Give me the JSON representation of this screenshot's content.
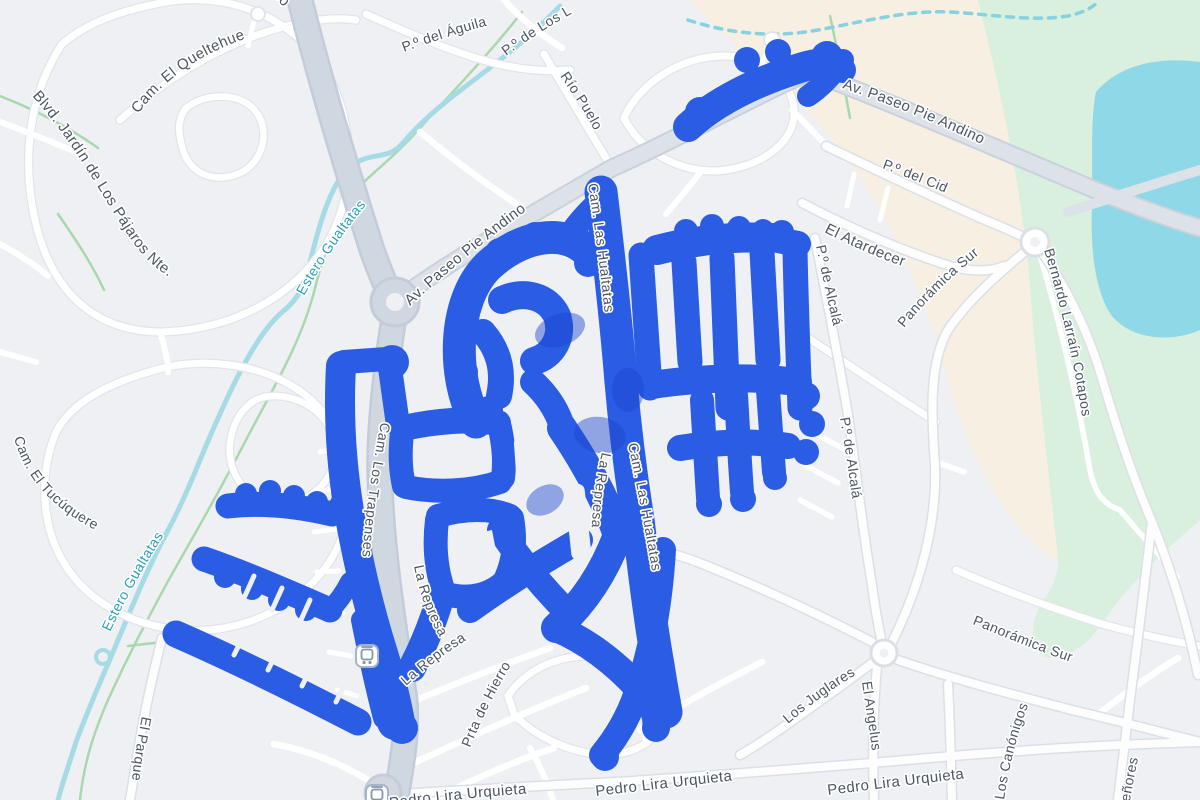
{
  "map": {
    "colors": {
      "background": "#eef0f4",
      "route_blue": "#2a5ce4",
      "route_dark_blue": "#1d45cd",
      "water_line": "#a6dbe5",
      "water_dashed": "#86d2e0",
      "lake": "#8ed8e8",
      "park_green": "#d9f0de",
      "sand_beige": "#f6efe2",
      "trail_green": "#a9d8ae",
      "road_major_fill": "#cfd7e1",
      "road_major_casing": "#c3ccd8",
      "road_minor_fill": "#ffffff",
      "road_minor_casing": "#e1e5ea",
      "street_label_color": "#4b5563",
      "water_label_color": "#2aa0b8"
    },
    "street_labels": [
      {
        "id": "andino-top",
        "text": "Andino",
        "kind": "street",
        "size": 15,
        "path": "M 252,-30 L 320,50"
      },
      {
        "id": "queltehue",
        "text": "Cam. El Queltehue",
        "kind": "street",
        "size": 15,
        "path": "M 138,114 C 170,72 210,48 266,32"
      },
      {
        "id": "blvd-jardin",
        "text": "Blvd. Jardín de Los Pájaros Nte.",
        "kind": "street",
        "size": 15,
        "path": "M 32,96 C 72,140 96,186 126,232 C 146,264 170,282 208,296"
      },
      {
        "id": "aguila",
        "text": "P.º del Águila",
        "kind": "street",
        "size": 14,
        "path": "M 404,52 C 436,40 468,30 502,22"
      },
      {
        "id": "de-los-l",
        "text": "P.º de Los L",
        "kind": "street",
        "size": 14,
        "path": "M 506,56 C 530,38 556,22 582,8"
      },
      {
        "id": "rio-puelo",
        "text": "Río Puelo",
        "kind": "street",
        "size": 14,
        "path": "M 560,76 C 576,98 590,120 600,142"
      },
      {
        "id": "estero-upper",
        "text": "Estero Gualtatas",
        "kind": "water",
        "size": 14,
        "path": "M 304,296 C 324,260 346,228 372,198"
      },
      {
        "id": "estero-lower",
        "text": "Estero Gualtatas",
        "kind": "water",
        "size": 14,
        "path": "M 110,632 C 130,590 152,552 178,514"
      },
      {
        "id": "andino-mid",
        "text": "Av. Paseo Pie Andino",
        "kind": "street",
        "size": 15,
        "path": "M 410,306 C 458,262 506,224 558,188"
      },
      {
        "id": "andino-tr",
        "text": "Av. Paseo Pie Andino",
        "kind": "street",
        "size": 15,
        "path": "M 842,88 C 896,106 950,128 1002,154"
      },
      {
        "id": "cid",
        "text": "P.º del Cid",
        "kind": "street",
        "size": 14,
        "path": "M 882,168 C 910,178 938,190 968,202"
      },
      {
        "id": "atardecer",
        "text": "El Atardecer",
        "kind": "street",
        "size": 15,
        "path": "M 824,232 C 856,248 888,262 920,272"
      },
      {
        "id": "panoramica-upper",
        "text": "Panorámica Sur",
        "kind": "street",
        "size": 14,
        "path": "M 904,328 C 930,296 962,266 998,240"
      },
      {
        "id": "cotapos",
        "text": "Bernardo Larraín Cotapos",
        "kind": "street",
        "size": 14,
        "path": "M 1044,250 C 1062,310 1076,370 1084,430 L 1090,456"
      },
      {
        "id": "alcala-upper",
        "text": "P.º de Alcalá",
        "kind": "street",
        "size": 14,
        "path": "M 816,246 C 824,284 832,322 842,362"
      },
      {
        "id": "alcala-lower",
        "text": "P.º de Alcalá",
        "kind": "street",
        "size": 14,
        "path": "M 840,418 C 846,452 850,486 856,522"
      },
      {
        "id": "trapenses",
        "text": "Cam. Los Trapenses",
        "kind": "street",
        "size": 14,
        "path": "M 381,422 C 372,468 365,514 362,562"
      },
      {
        "id": "hualtatas-upper",
        "text": "Cam. Las Hualtatas",
        "kind": "street",
        "size": 14,
        "path": "M 588,184 C 596,234 602,284 607,336"
      },
      {
        "id": "hualtatas-lower",
        "text": "Cam. Las Hualtatas",
        "kind": "street",
        "size": 14,
        "path": "M 628,444 C 640,500 650,556 659,614"
      },
      {
        "id": "represa-upper",
        "text": "La Represa",
        "kind": "street",
        "size": 14,
        "path": "M 602,452 C 594,488 590,524 592,560"
      },
      {
        "id": "represa-mid",
        "text": "La Represa",
        "kind": "street",
        "size": 14,
        "path": "M 414,566 C 420,598 432,628 452,656"
      },
      {
        "id": "represa-diag",
        "text": "La Represa",
        "kind": "street",
        "size": 14,
        "path": "M 406,686 C 428,666 452,648 480,632"
      },
      {
        "id": "prta-hierro",
        "text": "Prta de Hierro",
        "kind": "street",
        "size": 14,
        "path": "M 470,748 C 486,708 506,670 530,636"
      },
      {
        "id": "el-parque",
        "text": "El Parque",
        "kind": "street",
        "size": 14,
        "path": "M 142,716 C 136,746 132,774 130,802"
      },
      {
        "id": "tucuquere",
        "text": "Cam. El Tucúquere",
        "kind": "street",
        "size": 14,
        "path": "M 14,438 C 26,480 54,512 110,537"
      },
      {
        "id": "juglares",
        "text": "Los Juglares",
        "kind": "street",
        "size": 14,
        "path": "M 788,724 C 812,703 838,684 868,668"
      },
      {
        "id": "angelus",
        "text": "El Angelus",
        "kind": "street",
        "size": 14,
        "path": "M 862,682 C 866,710 871,738 874,768"
      },
      {
        "id": "panoramica-lower",
        "text": "Panorámica Sur",
        "kind": "street",
        "size": 14,
        "path": "M 972,624 C 1012,640 1050,656 1090,668"
      },
      {
        "id": "canonigos",
        "text": "Los Canónigos",
        "kind": "street",
        "size": 14,
        "path": "M 1004,800 C 1010,760 1020,722 1036,686"
      },
      {
        "id": "senores",
        "text": "Señores",
        "kind": "street",
        "size": 14,
        "path": "M 1128,812 C 1134,776 1141,742 1150,708"
      },
      {
        "id": "urquieta-1",
        "text": "Pedro Lira Urquieta",
        "kind": "street",
        "size": 15,
        "path": "M 390,808 C 450,799 510,794 572,791"
      },
      {
        "id": "urquieta-2",
        "text": "Pedro Lira Urquieta",
        "kind": "street",
        "size": 15,
        "path": "M 596,796 C 648,790 700,784 754,778"
      },
      {
        "id": "urquieta-3",
        "text": "Pedro Lira Urquieta",
        "kind": "street",
        "size": 15,
        "path": "M 828,795 C 882,788 934,782 992,775"
      }
    ],
    "route_strokes": [
      {
        "d": "M 688,127 C 715,102 755,82 800,68 C 815,63 828,62 838,66",
        "w": 30
      },
      {
        "d": "M 843,60 C 832,76 820,88 808,96",
        "w": 22
      },
      {
        "d": "M 601,192 C 608,250 615,310 620,370 C 624,420 630,470 638,520 C 644,570 650,620 658,665 C 661,685 664,700 666,712",
        "w": 33
      },
      {
        "d": "M 572,232 C 584,216 596,204 606,197",
        "w": 24
      },
      {
        "d": "M 476,422 C 452,378 452,302 488,266 C 520,236 562,228 586,250",
        "w": 33
      },
      {
        "d": "M 502,300 C 524,290 548,296 557,316 C 564,336 553,356 534,361",
        "w": 28
      },
      {
        "d": "M 483,332 C 497,348 505,368 499,396",
        "w": 26
      },
      {
        "d": "M 533,382 C 546,394 556,408 562,426",
        "w": 26
      },
      {
        "d": "M 657,250 C 695,240 735,236 772,238",
        "w": 30
      },
      {
        "d": "M 778,240 L 798,244",
        "w": 26
      },
      {
        "d": "M 641,255 C 644,300 647,345 650,388",
        "w": 25
      },
      {
        "d": "M 684,262 C 686,300 688,330 690,362",
        "w": 25
      },
      {
        "d": "M 722,258 C 724,305 726,360 728,408",
        "w": 25
      },
      {
        "d": "M 762,252 C 764,290 766,325 768,360",
        "w": 25
      },
      {
        "d": "M 795,250 C 796,300 798,355 800,408",
        "w": 25
      },
      {
        "d": "M 652,385 C 700,378 750,376 798,382",
        "w": 28
      },
      {
        "d": "M 680,448 C 715,442 750,440 788,446",
        "w": 26
      },
      {
        "d": "M 702,400 C 704,435 706,470 708,498",
        "w": 24
      },
      {
        "d": "M 736,395 C 738,430 740,465 742,492",
        "w": 24
      },
      {
        "d": "M 768,390 C 770,418 772,448 774,472",
        "w": 24
      },
      {
        "d": "M 622,372 C 635,378 648,382 658,385",
        "w": 24
      },
      {
        "d": "M 404,428 C 435,421 470,418 498,423",
        "w": 26
      },
      {
        "d": "M 402,432 C 400,452 400,468 404,486",
        "w": 24
      },
      {
        "d": "M 500,428 C 504,448 505,462 503,478",
        "w": 24
      },
      {
        "d": "M 406,487 C 435,493 470,492 500,482",
        "w": 24
      },
      {
        "d": "M 438,516 C 465,508 492,508 510,516",
        "w": 24
      },
      {
        "d": "M 437,520 C 434,545 436,570 444,592",
        "w": 24
      },
      {
        "d": "M 512,518 C 516,540 514,560 506,578",
        "w": 24
      },
      {
        "d": "M 446,594 C 468,600 490,596 506,580",
        "w": 24
      },
      {
        "d": "M 470,610 C 505,585 545,560 580,540",
        "w": 26
      },
      {
        "d": "M 500,530 C 520,560 545,590 570,615",
        "w": 26
      },
      {
        "d": "M 442,592 C 434,620 424,645 412,668",
        "w": 28
      },
      {
        "d": "M 390,368 L 398,425",
        "w": 24
      },
      {
        "d": "M 344,362 L 386,359",
        "w": 24
      },
      {
        "d": "M 562,428 C 585,462 605,498 618,535",
        "w": 30
      },
      {
        "d": "M 618,535 C 603,575 582,605 556,628",
        "w": 30
      },
      {
        "d": "M 556,628 C 585,640 615,662 640,690 C 652,702 658,716 656,728",
        "w": 28
      },
      {
        "d": "M 663,550 C 660,600 652,650 636,695 C 628,718 616,738 602,755",
        "w": 26
      },
      {
        "d": "M 228,506 C 262,502 298,506 332,514",
        "w": 25
      },
      {
        "d": "M 334,513 C 340,505 343,498 345,491",
        "w": 20
      },
      {
        "d": "M 204,559 C 245,573 288,592 330,610",
        "w": 25
      },
      {
        "d": "M 330,610 C 340,600 346,590 350,582",
        "w": 20
      },
      {
        "d": "M 176,634 C 240,662 300,692 358,722",
        "w": 27
      },
      {
        "d": "M 341,366 C 338,420 342,475 352,528 C 360,570 370,612 382,650 C 390,676 396,700 400,722",
        "w": 30
      },
      {
        "d": "M 362,620 C 370,660 378,695 384,718",
        "w": 22
      }
    ],
    "route_bumps": [
      [
        700,
        112,
        15
      ],
      [
        747,
        60,
        13
      ],
      [
        778,
        52,
        13
      ],
      [
        827,
        57,
        16
      ],
      [
        843,
        70,
        13
      ],
      [
        470,
        290,
        15
      ],
      [
        500,
        253,
        15
      ],
      [
        535,
        236,
        14
      ],
      [
        567,
        241,
        14
      ],
      [
        588,
        263,
        14
      ],
      [
        462,
        332,
        14
      ],
      [
        464,
        372,
        14
      ],
      [
        489,
        410,
        14
      ],
      [
        686,
        231,
        12
      ],
      [
        712,
        226,
        12
      ],
      [
        739,
        228,
        12
      ],
      [
        763,
        230,
        11
      ],
      [
        782,
        232,
        12
      ],
      [
        709,
        504,
        13
      ],
      [
        743,
        499,
        13
      ],
      [
        775,
        478,
        12
      ],
      [
        806,
        396,
        14
      ],
      [
        812,
        424,
        13
      ],
      [
        806,
        452,
        13
      ],
      [
        246,
        494,
        11
      ],
      [
        270,
        491,
        11
      ],
      [
        294,
        496,
        11
      ],
      [
        317,
        502,
        11
      ],
      [
        225,
        577,
        11
      ],
      [
        252,
        589,
        11
      ],
      [
        279,
        600,
        11
      ],
      [
        306,
        610,
        11
      ],
      [
        392,
        362,
        17
      ],
      [
        402,
        728,
        16
      ],
      [
        395,
        722,
        18
      ],
      [
        605,
        757,
        14
      ],
      [
        656,
        728,
        13
      ]
    ],
    "route_dark_patches": [
      [
        560,
        330,
        26,
        16,
        -20
      ],
      [
        600,
        435,
        26,
        18,
        10
      ],
      [
        628,
        390,
        16,
        22,
        0
      ],
      [
        545,
        500,
        20,
        14,
        -30
      ]
    ],
    "route_white_rects": [
      [
        417,
        452,
        62,
        18,
        2
      ],
      [
        568,
        484,
        20,
        76,
        -6
      ],
      [
        515,
        436,
        14,
        44,
        -4
      ]
    ],
    "route_white_poly": "466,536 492,530 497,556 470,563",
    "route_white_ticks": [
      [
        234,
        655,
        246,
        631
      ],
      [
        268,
        670,
        280,
        646
      ],
      [
        302,
        686,
        314,
        662
      ],
      [
        336,
        702,
        348,
        678
      ],
      [
        244,
        598,
        254,
        576
      ],
      [
        272,
        610,
        282,
        588
      ],
      [
        300,
        622,
        310,
        600
      ]
    ],
    "icons": [
      {
        "name": "transit-station-icon",
        "x": 367,
        "y": 656
      },
      {
        "name": "transit-station-icon",
        "x": 377,
        "y": 796
      }
    ]
  }
}
